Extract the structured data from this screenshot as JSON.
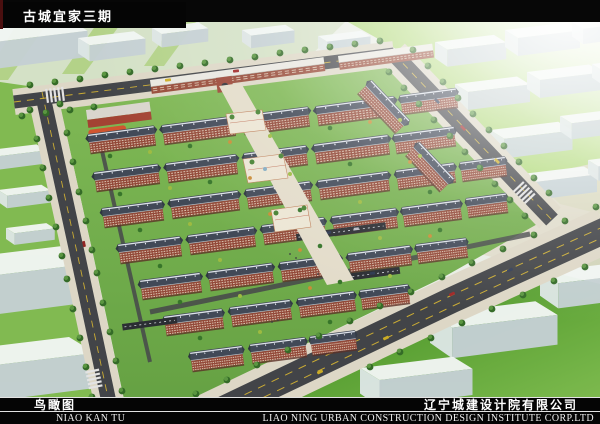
{
  "header": {
    "project_title": "古城宜家三期"
  },
  "footer": {
    "drawing_name_cn": "鸟瞰图",
    "drawing_name_pinyin": "NIAO KAN TU",
    "company_cn": "辽宁城建设计院有限公司",
    "company_en": "LIAO NING URBAN CONSTRUCTION DESIGN INSTITUTE CORP.LTD"
  },
  "palette": {
    "title_bar_bg": "#050505",
    "title_text": "#ffffff",
    "road": "#3b3d41",
    "lane_marking_yellow": "#c9a92c",
    "sidewalk": "#dcd6c4",
    "site_lawn": "#6fae45",
    "context_lawn": "#8cc449",
    "apartment_roof": "#3a4251",
    "apartment_brick": "#8e4130",
    "context_building": "#f2f6f4",
    "playground_orange": "#d4582b",
    "tree_green": "#2c651f"
  }
}
